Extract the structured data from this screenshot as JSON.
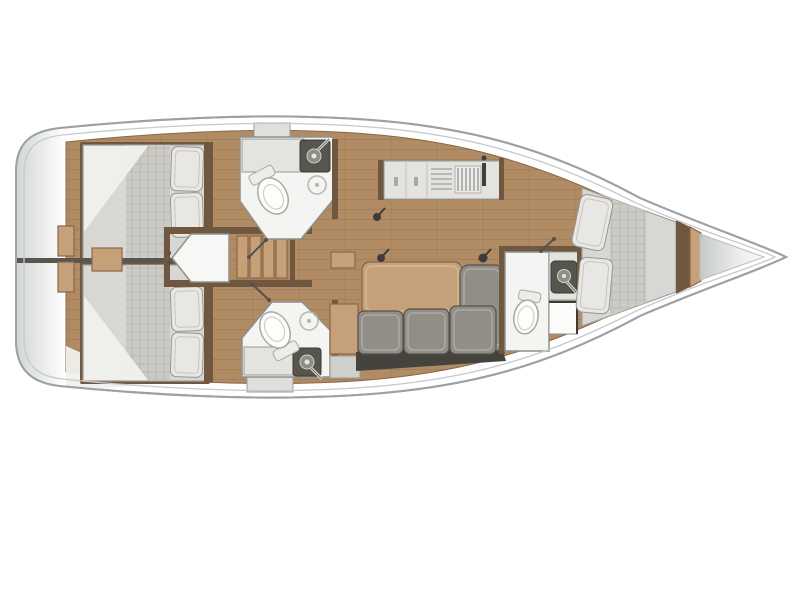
{
  "title": "Sailing yacht interior layout — top-down deck plan, bow to the right",
  "figure": {
    "type": "boat-floor-plan",
    "view": "overhead",
    "orientation": "bow-right"
  },
  "colors": {
    "white": "#ffffff",
    "hull_stroke": "#9ba1a5",
    "inner_line": "#c6cacc",
    "wood": "#b08b64",
    "wood_edge": "#8a6747",
    "wood_light": "#c6a078",
    "wood_dark": "#6f5740",
    "mattress": "#d8d7d3",
    "mattress_stroke": "#a3a29e",
    "pillow": "#e8e7e3",
    "pillow_stroke": "#97968f",
    "cushion": "#908e86",
    "cushion_stroke": "#55534d",
    "cushion_dark": "#45433d",
    "counter": "#e3e3df",
    "counter_stroke": "#9a9a96",
    "fixture": "#56564e",
    "room": "#f4f4f2",
    "room_stroke": "#8f8f8b",
    "locker": "#dfdfdd",
    "toilet": "#fdfdfc",
    "toilet_stroke": "#a9a8a4",
    "post": "#3e3c38",
    "wedge": "#f0f0ed",
    "divider": "#5a564f"
  },
  "plan": {
    "rooms": [
      {
        "id": "aft-cabin-port",
        "label": "Aft double cabin (port)",
        "furniture": [
          "double-berth",
          "pillow",
          "pillow"
        ]
      },
      {
        "id": "aft-cabin-starboard",
        "label": "Aft double cabin (starboard)",
        "furniture": [
          "double-berth",
          "pillow",
          "pillow"
        ]
      },
      {
        "id": "head-port",
        "label": "Head with shower (port)",
        "furniture": [
          "toilet",
          "washbasin",
          "shower"
        ]
      },
      {
        "id": "head-starboard",
        "label": "Head with shower (starboard)",
        "furniture": [
          "toilet",
          "washbasin",
          "shower"
        ]
      },
      {
        "id": "companionway",
        "label": "Companionway",
        "furniture": [
          "steps",
          "engine-box"
        ]
      },
      {
        "id": "galley",
        "label": "Galley",
        "furniture": [
          "cabinet",
          "sink-drainboard",
          "stove"
        ]
      },
      {
        "id": "salon",
        "label": "Salon",
        "furniture": [
          "dining-table",
          "l-shaped-sofa",
          "bench-seat"
        ]
      },
      {
        "id": "forward-head",
        "label": "Forward head",
        "furniture": [
          "toilet",
          "washbasin",
          "vanity-seat"
        ]
      },
      {
        "id": "forward-cabin",
        "label": "Forward V-berth cabin",
        "furniture": [
          "v-berth",
          "pillow",
          "pillow"
        ]
      },
      {
        "id": "bow-locker",
        "label": "Bow anchor locker",
        "furniture": []
      }
    ]
  }
}
